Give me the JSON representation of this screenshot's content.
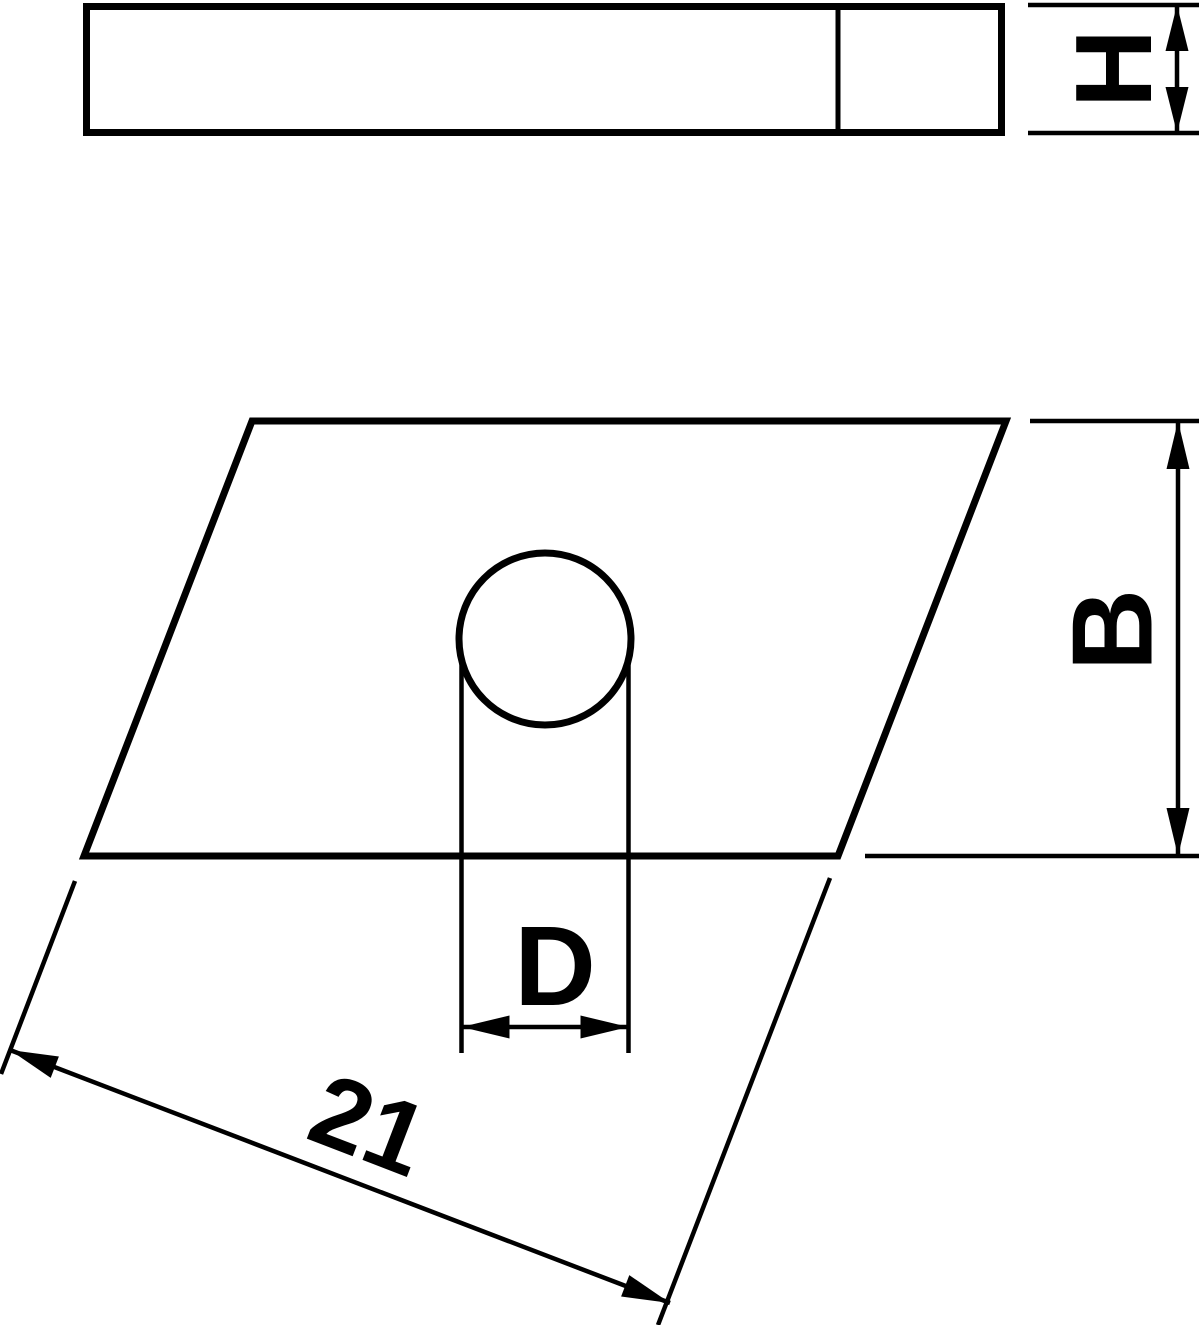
{
  "drawing": {
    "background_color": "#ffffff",
    "line_color": "#000000",
    "dimensions": {
      "height": {
        "label": "H"
      },
      "width": {
        "label": "B"
      },
      "hole_diameter": {
        "label": "D"
      },
      "length": {
        "label": "21",
        "value": 21
      }
    }
  }
}
